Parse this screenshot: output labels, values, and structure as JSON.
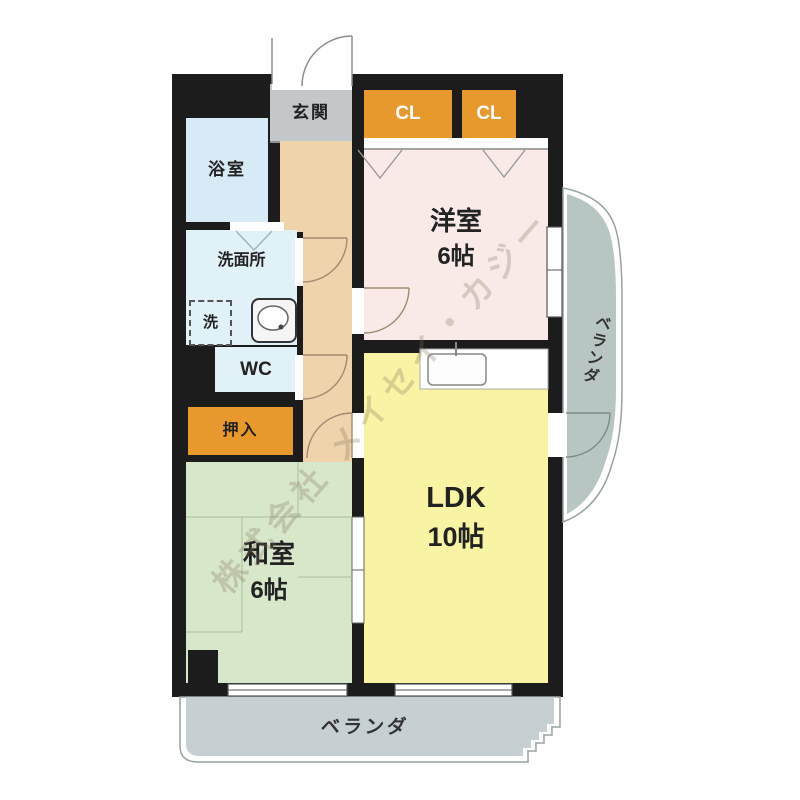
{
  "floorplan": {
    "rooms": {
      "genkan": {
        "label": "玄関"
      },
      "cl1": {
        "label": "CL"
      },
      "cl2": {
        "label": "CL"
      },
      "yokushitsu": {
        "label": "浴室"
      },
      "senmenjo": {
        "label": "洗面所"
      },
      "sentakuki": {
        "label": "洗"
      },
      "wc": {
        "label": "WC"
      },
      "oshiire": {
        "label": "押入"
      },
      "yoshitsu": {
        "label": "洋室",
        "size": "6帖"
      },
      "washitsu": {
        "label": "和室",
        "size": "6帖"
      },
      "ldk": {
        "label": "LDK",
        "size": "10帖"
      },
      "veranda_bottom": {
        "label": "ベランダ"
      },
      "veranda_right": {
        "label": "ベランダ"
      }
    },
    "watermark": "株式会社 メイセイ・カジー",
    "colors": {
      "walls": "#1c1c1c",
      "genkan": "#c3c7ca",
      "corridor": "#eed3ab",
      "closet_orange": "#e8992e",
      "western_room": "#f9eae8",
      "ldk": "#f8f4a4",
      "japanese_room": "#d7e7c9",
      "bath": "#d6ebf5",
      "washroom": "#e0f1f8",
      "wc": "#e0f1f8",
      "balcony_bottom": "#c6cfd2",
      "balcony_right": "#b7c6c3"
    }
  }
}
